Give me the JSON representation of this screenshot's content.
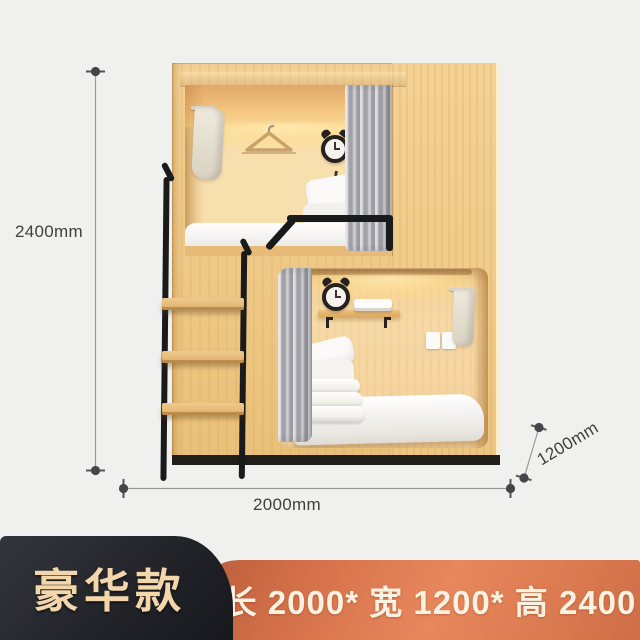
{
  "canvas": {
    "background": "#f0f0ee"
  },
  "annotations": {
    "height": "2400mm",
    "length": "2000mm",
    "depth": "1200mm",
    "line_color": "#9a9a9a",
    "marker_color": "#46464a",
    "text_color": "#3f3f42"
  },
  "scene": {
    "wood_color": "#eec685",
    "interior_glow_color": "#ffe7ae",
    "curtain_color": "#b9b9be",
    "metal_color": "#1a1a1c",
    "bedding_color": "#ffffff",
    "plinth_color": "#201d1a",
    "objects": [
      "capsule-bunk-bed",
      "ladder",
      "handrail",
      "towels",
      "clothes-hanger",
      "alarm-clocks",
      "pillows",
      "folded-quilts",
      "mattress",
      "wall-shelf",
      "power-socket",
      "curtains",
      "led-strip-light"
    ]
  },
  "footer": {
    "model_badge": {
      "label": "豪华款",
      "background": "#22242a",
      "text_color": "#f3d7aa"
    },
    "spec_banner": {
      "label": "长 2000* 宽 1200* 高 2400",
      "background": "#d9774b",
      "text_color": "#fbf2e2"
    }
  }
}
